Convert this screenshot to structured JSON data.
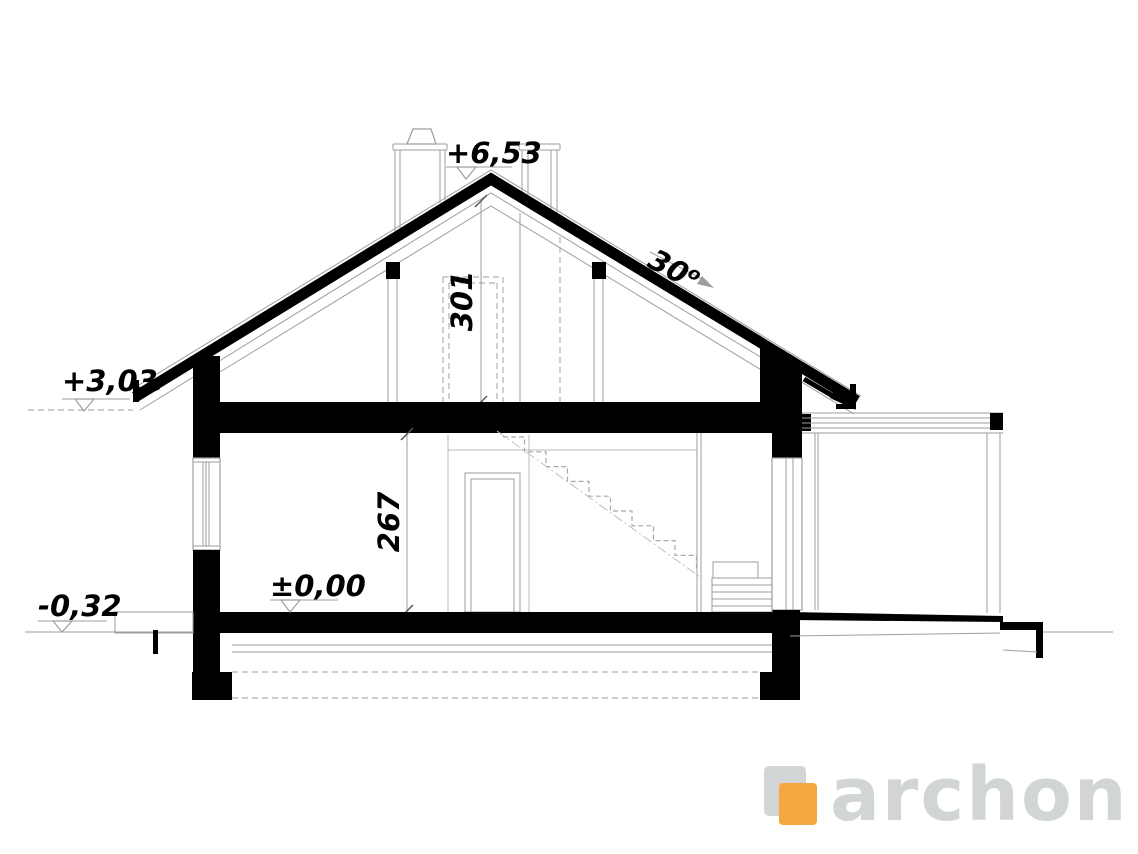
{
  "drawing": {
    "levels": {
      "ridge_label": "+6,53",
      "eave_label": "+3,03",
      "floor_label": "±0,00",
      "ground_label": "-0,32"
    },
    "dimensions": {
      "attic_height": "301",
      "room_height": "267",
      "roof_angle": "30",
      "roof_angle_superscript": "o"
    },
    "logo": {
      "text": "archon",
      "gray": "#D2D5D6",
      "orange": "#F6A63E"
    }
  }
}
